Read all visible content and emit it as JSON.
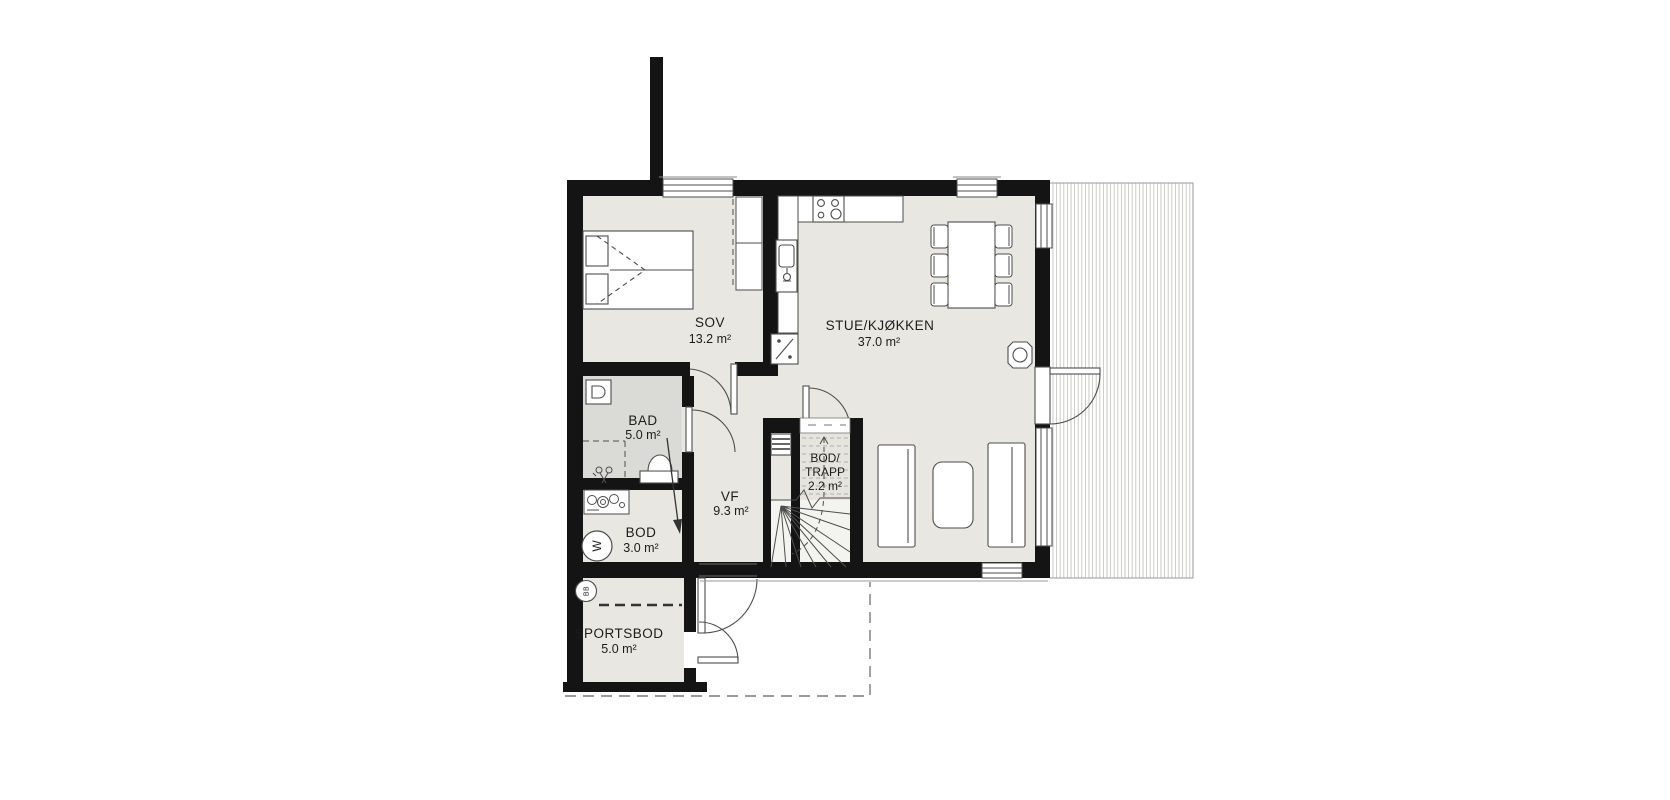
{
  "floorplan": {
    "title": "floor-plan",
    "rooms": [
      {
        "name": "SOV",
        "area": "13.2 m²"
      },
      {
        "name": "STUE/KJØKKEN",
        "area": "37.0 m²"
      },
      {
        "name": "BAD",
        "area": "5.0 m²"
      },
      {
        "name": "VF",
        "area": "9.3 m²"
      },
      {
        "name": "BOD/",
        "name2": "TRAPP",
        "area": "2.2 m²"
      },
      {
        "name": "BOD",
        "area": "3.0 m²"
      },
      {
        "name": "SPORTSBOD",
        "area": "5.0 m²"
      }
    ],
    "icons": {
      "washing_machine": "W",
      "floor_drain": "BB"
    },
    "colors": {
      "wall": "#141414",
      "floor": "#e8e7e1",
      "bath_floor": "#dadad6",
      "stair_floor": "#f3f3ef",
      "line": "#4d4d4d",
      "deck_line": "#c6c6c2",
      "dash_line": "#7a7a7a"
    }
  }
}
